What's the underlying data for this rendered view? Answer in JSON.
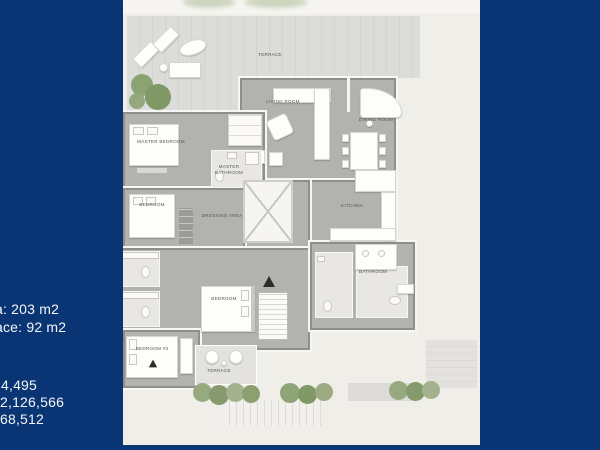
{
  "slide": {
    "background_color": "#0a3575",
    "plan_background_color": "#efeee8"
  },
  "info_panel": {
    "area_text": "a: 203 m2",
    "terrace_text": "ace: 92 m2",
    "figures": [
      "4,495",
      "2,126,566",
      "68,512"
    ]
  },
  "floor_plan": {
    "labels": {
      "terrace_main": "TERRACE",
      "living_room": "LIVING ROOM",
      "dining_room": "DINING ROOM",
      "kitchen": "KITCHEN",
      "master_bedroom": "MASTER BEDROOM",
      "master_bathroom": "MASTER BATHROOM",
      "bedroom_upper": "BEDROOM",
      "dressing_area": "DRESSING AREA",
      "bedroom_middle": "BEDROOM",
      "bedroom_lower": "BEDROOM #3",
      "terrace_small": "TERRACE",
      "bathroom_right": "BATHROOM"
    }
  }
}
